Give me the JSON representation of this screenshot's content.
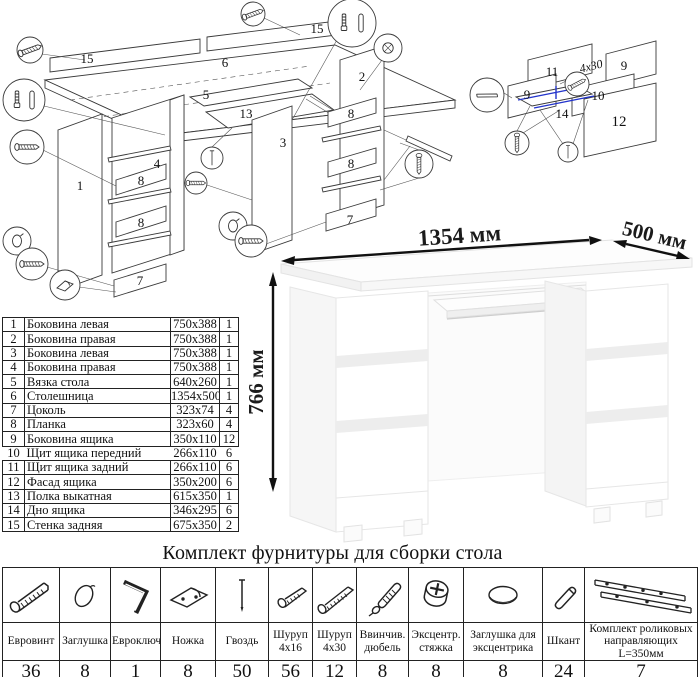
{
  "doc": {
    "hardware_title": "Комплект фурнитуры для сборки стола"
  },
  "dimensions": {
    "width": "1354 мм",
    "depth": "500 мм",
    "height": "766 мм"
  },
  "parts": {
    "rows": [
      {
        "num": "1",
        "name": "Боковина левая",
        "size": "750x388",
        "qty": "1"
      },
      {
        "num": "2",
        "name": "Боковина правая",
        "size": "750x388",
        "qty": "1"
      },
      {
        "num": "3",
        "name": "Боковина левая",
        "size": "750x388",
        "qty": "1"
      },
      {
        "num": "4",
        "name": "Боковина правая",
        "size": "750x388",
        "qty": "1"
      },
      {
        "num": "5",
        "name": "Вязка стола",
        "size": "640x260",
        "qty": "1"
      },
      {
        "num": "6",
        "name": "Столешница",
        "size": "1354x500",
        "qty": "1"
      },
      {
        "num": "7",
        "name": "Цоколь",
        "size": "323x74",
        "qty": "4"
      },
      {
        "num": "8",
        "name": "Планка",
        "size": "323x60",
        "qty": "4"
      },
      {
        "num": "9",
        "name": "Боковина ящика",
        "size": "350x110",
        "qty": "12"
      },
      {
        "num": "10",
        "name": "Щит ящика передний",
        "size": "266x110",
        "qty": "6"
      },
      {
        "num": "11",
        "name": "Щит ящика задний",
        "size": "266x110",
        "qty": "6"
      },
      {
        "num": "12",
        "name": "Фасад ящика",
        "size": "350x200",
        "qty": "6"
      },
      {
        "num": "13",
        "name": "Полка выкатная",
        "size": "615x350",
        "qty": "1"
      },
      {
        "num": "14",
        "name": "Дно ящика",
        "size": "346x295",
        "qty": "6"
      },
      {
        "num": "15",
        "name": "Стенка задняя",
        "size": "675x350",
        "qty": "2"
      }
    ]
  },
  "hardware": {
    "items": [
      {
        "name": "Евровинт",
        "qty": "36",
        "icon": "confirmat-screw-icon"
      },
      {
        "name": "Заглушка",
        "qty": "8",
        "icon": "cap-icon"
      },
      {
        "name": "Евроключ",
        "qty": "1",
        "icon": "hex-key-icon"
      },
      {
        "name": "Ножка",
        "qty": "8",
        "icon": "foot-icon"
      },
      {
        "name": "Гвоздь",
        "qty": "50",
        "icon": "nail-icon"
      },
      {
        "name": "Шуруп 4x16",
        "qty": "56",
        "icon": "screw-short-icon"
      },
      {
        "name": "Шуруп 4x30",
        "qty": "12",
        "icon": "screw-long-icon"
      },
      {
        "name": "Ввинчив. дюбель",
        "qty": "8",
        "icon": "screw-in-dowel-icon"
      },
      {
        "name": "Эксцентр. стяжка",
        "qty": "8",
        "icon": "cam-lock-icon"
      },
      {
        "name": "Заглушка для эксцентрика",
        "qty": "8",
        "icon": "cam-cap-icon"
      },
      {
        "name": "Шкант",
        "qty": "24",
        "icon": "wood-dowel-icon"
      },
      {
        "name": "Комплект роликовых направляющих L=350мм",
        "qty": "7",
        "icon": "roller-slides-icon"
      }
    ]
  },
  "exploded": {
    "p1": "1",
    "p2": "2",
    "p3": "3",
    "p4": "4",
    "p5": "5",
    "p6": "6",
    "p7": "7",
    "p8": "8",
    "p13": "13",
    "p15": "15"
  },
  "drawer_detail": {
    "p9": "9",
    "p10": "10",
    "p11": "11",
    "p12": "12",
    "p14": "14",
    "screw_note": "4х30"
  }
}
